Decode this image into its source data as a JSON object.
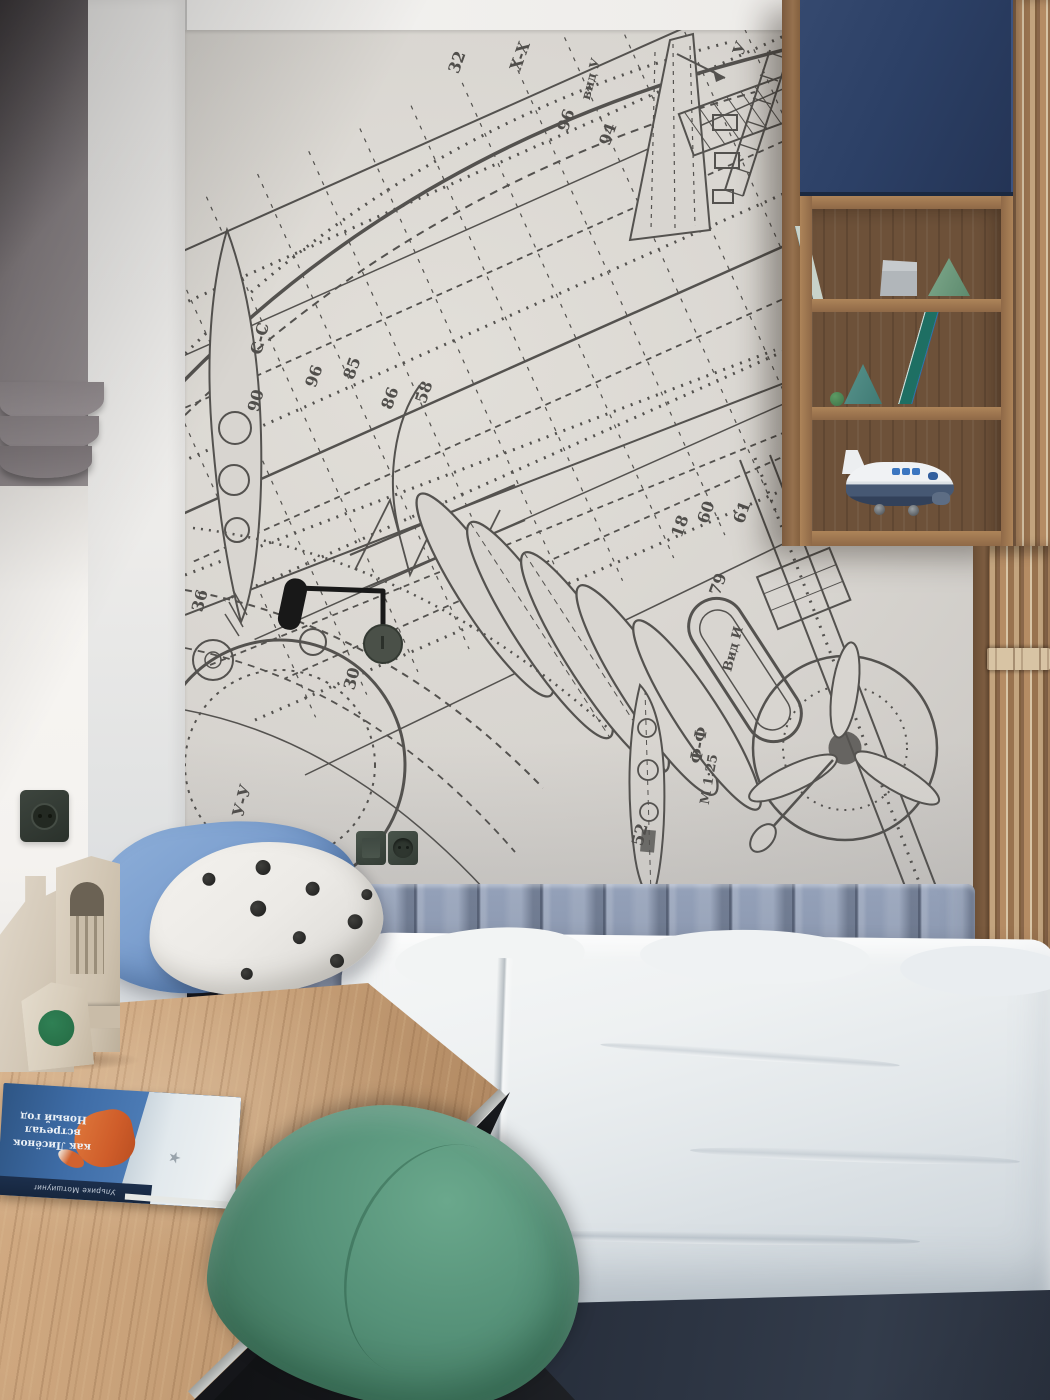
{
  "wallpaper": {
    "labels": [
      "32",
      "X-X",
      "вид У",
      "У",
      "96",
      "94",
      "С-С",
      "90",
      "96",
      "85",
      "86",
      "58",
      "36",
      "30",
      "У-У",
      "60",
      "61",
      "79",
      "Вид И",
      "Ф-Ф",
      "М 1:25",
      "52",
      "18"
    ]
  },
  "book": {
    "title_line1": "как Лисёнок",
    "title_line2": "встречал Новый год",
    "author": "Ульрике Мотшиуниг"
  },
  "palette": {
    "wallpaper_bg": "#d9d6d1",
    "blueprint_ink": "#54524f",
    "cabinet_navy": "#2c4066",
    "shelf_wood": "#96714e",
    "slat_wood": "#a57e5b",
    "headboard_blue_gray": "#8793ab",
    "duvet_white": "#eef1f2",
    "bed_base_navy": "#2c3442",
    "pillow_blue": "#7da0cf",
    "chair_green": "#4f8e72",
    "desk_wood": "#c8a179",
    "curtain_gray": "#8d8689",
    "travertine": "#d6ccbc",
    "outlet_green_gray": "#3b443d",
    "lamp_black": "#1d1d1d"
  }
}
